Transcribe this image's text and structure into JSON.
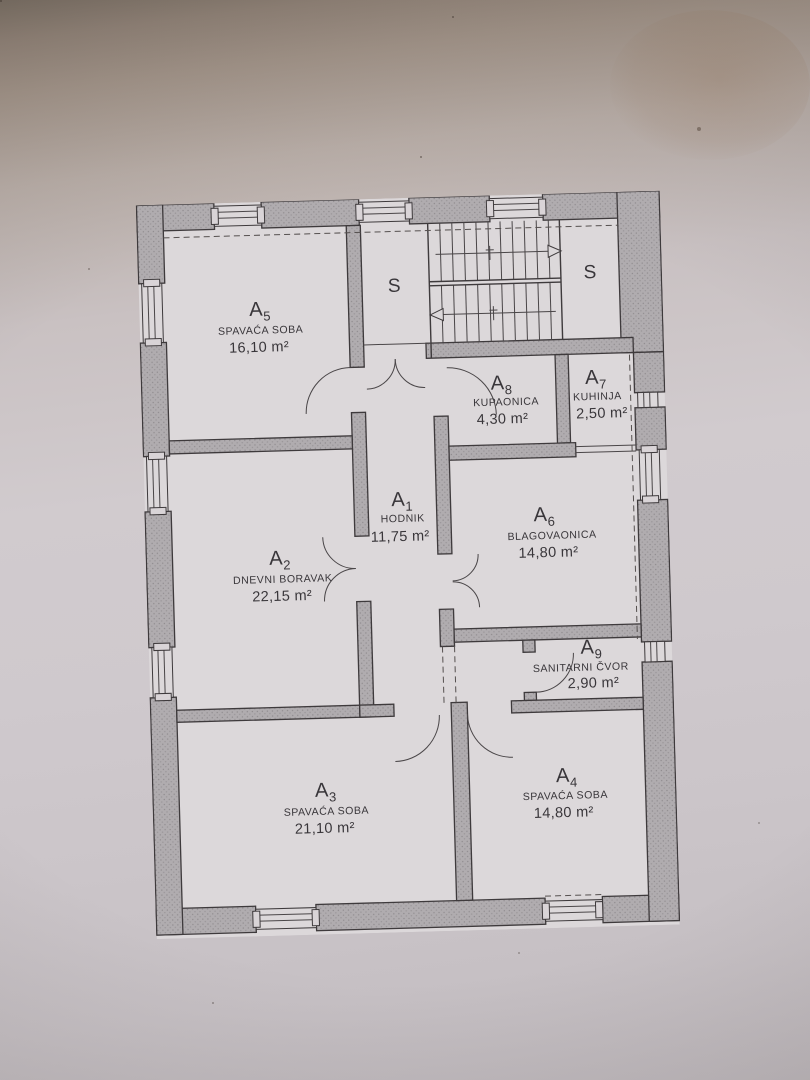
{
  "palette": {
    "paper": "#d9d4d7",
    "wall_fill": "#aeaaad",
    "line": "#3e3a3c",
    "text": "#39363a"
  },
  "plan": {
    "rooms": [
      {
        "key": "a1",
        "code": "A",
        "sub": "1",
        "name": "HODNIK",
        "area": "11,75 m²"
      },
      {
        "key": "a2",
        "code": "A",
        "sub": "2",
        "name": "DNEVNI BORAVAK",
        "area": "22,15 m²"
      },
      {
        "key": "a3",
        "code": "A",
        "sub": "3",
        "name": "SPAVAĆA SOBA",
        "area": "21,10 m²"
      },
      {
        "key": "a4",
        "code": "A",
        "sub": "4",
        "name": "SPAVAĆA SOBA",
        "area": "14,80 m²"
      },
      {
        "key": "a5",
        "code": "A",
        "sub": "5",
        "name": "SPAVAĆA SOBA",
        "area": "16,10 m²"
      },
      {
        "key": "a6",
        "code": "A",
        "sub": "6",
        "name": "BLAGOVAONICA",
        "area": "14,80 m²"
      },
      {
        "key": "a7",
        "code": "A",
        "sub": "7",
        "name": "KUHINJA",
        "area": "2,50 m²"
      },
      {
        "key": "a8",
        "code": "A",
        "sub": "8",
        "name": "KUPAONICA",
        "area": "4,30 m²"
      },
      {
        "key": "a9",
        "code": "A",
        "sub": "9",
        "name": "SANITARNI ČVOR",
        "area": "2,90 m²"
      }
    ],
    "closets": [
      {
        "label": "S"
      },
      {
        "label": "S"
      }
    ]
  }
}
